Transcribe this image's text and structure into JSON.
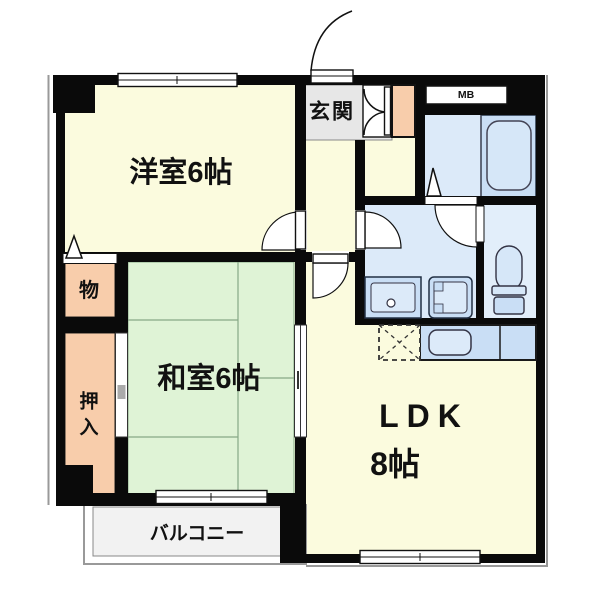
{
  "floor_plan": {
    "title": "apartment-floor-plan",
    "rooms": {
      "western_room": "洋室6帖",
      "japanese_room": "和室6帖",
      "ldk_line1": "LDK",
      "ldk_line2": "8帖",
      "entrance": "玄関",
      "storage": "物",
      "closet_char1": "押",
      "closet_char2": "入",
      "balcony": "バルコニー",
      "meter_box": "MB"
    },
    "fixtures": [
      "bathtub",
      "toilet",
      "vanity-sink",
      "washing-machine-space",
      "kitchen-sink",
      "kitchen-counter",
      "refrigerator-space",
      "shoe-cabinet",
      "entrance-closet",
      "meter-box"
    ],
    "colors": {
      "wall": "#0a0a0a",
      "room_cream": "#FBFBDE",
      "tatami_green": "#DFF3D6",
      "closet_salmon": "#F8CDAB",
      "entrance_gray": "#E7E7E7",
      "wet_area_blue": "#DCEAF9",
      "fixture_blue": "#C9DEF5",
      "balcony_gray": "#F2F2F2"
    }
  }
}
